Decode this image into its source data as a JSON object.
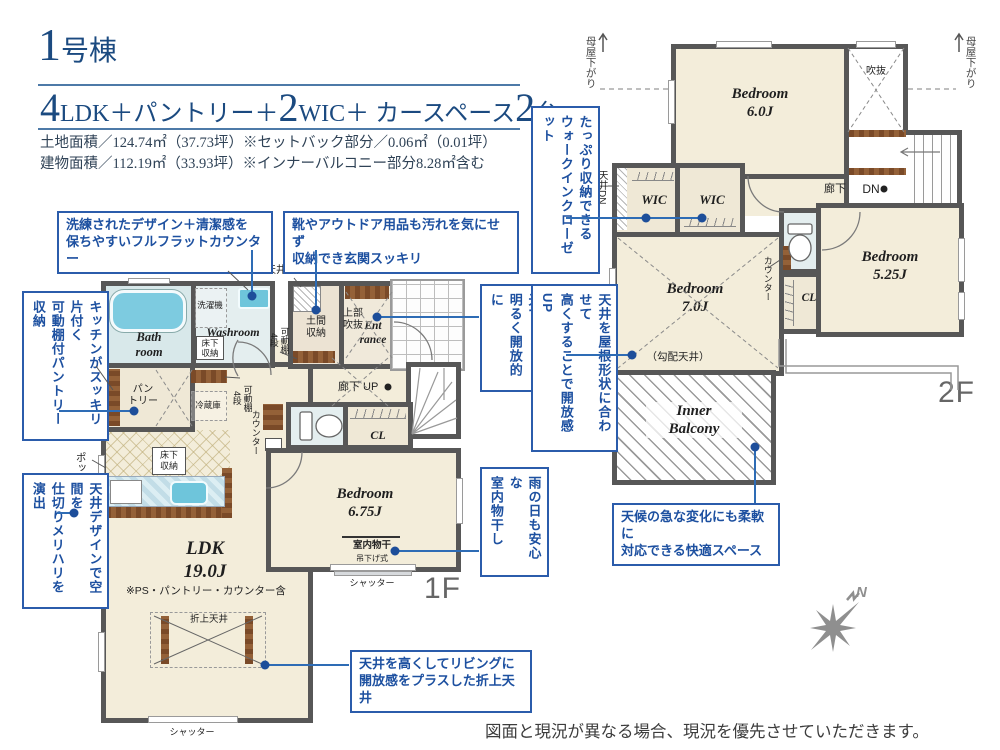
{
  "header": {
    "title_num": "1",
    "title_suffix": "号棟",
    "plan": {
      "n1": "4",
      "t1": "LDK＋パントリー＋",
      "n2": "2",
      "t2": "WIC＋ カースペース",
      "n3": "2",
      "t3": "台"
    },
    "land_area": "土地面積／124.74㎡（37.73坪）※セットバック部分／0.06㎡（0.01坪）",
    "building_area": "建物面積／112.19㎡（33.93坪）※インナーバルコニー部分8.28㎡含む"
  },
  "callouts": {
    "flat_counter": "洗練されたデザイン＋清潔感を\n保ちやすいフルフラットカウンター",
    "genkan": "靴やアウトドア用品も汚れを気にせず\n収納でき玄関スッキリ",
    "pantry": "キッチンがスッキリ片付く\n可動棚付パントリー収納",
    "ceiling_design": "天井デザインで空間を\n仕切りメリハリを演出",
    "void_light": "吹抜からの採光で\n明るく開放的に",
    "indoor_drying": "雨の日も安心な\n室内物干し",
    "oriage": "天井を高くしてリビングに\n開放感をプラスした折上天井",
    "wic": "たっぷり収納できる\nウォークインクローゼット",
    "sloped_ceiling": "天井を屋根形状に合わせて\n高くすることで開放感UP",
    "balcony": "天候の急な変化にも柔軟に\n対応できる快適スペース"
  },
  "f1": {
    "floor": "1F",
    "bath": "Bath\nroom",
    "washroom": "Washroom",
    "washer": "洗濯機",
    "open_sanitary": "オープンサニタリー\nirodori",
    "ceiling_dn": "天井DN",
    "doma": "土間\n収納",
    "upper_void": "上部\n吹抜",
    "entrance": "Ent\nrance",
    "hallway_up": "廊下 UP",
    "shelf_a": "可動棚\n4段",
    "shelf_b": "可動棚\n4段",
    "shelf_c": "可動棚\n4段",
    "pantry": "パン\nトリー",
    "fridge": "冷蔵庫",
    "underfloor_wash": "床下\n収納",
    "underfloor_kitchen": "床下\n収納",
    "counter": "カウンター",
    "ps": "PS",
    "cl": "CL",
    "bedroom": "Bedroom\n6.75J",
    "monohoshi": "室内物干",
    "monohoshi_sub": "吊下げ式",
    "shutter_bedroom": "シャッター",
    "shutter_ldk": "シャッター",
    "ldk": "LDK\n19.0J",
    "ldk_note": "※PS・パントリー・カウンター含",
    "oriage": "折上天井",
    "popup": "ポップアップ天井"
  },
  "f2": {
    "floor": "2F",
    "bedroom6": "Bedroom\n6.0J",
    "void": "吹抜",
    "hallway": "廊下",
    "dn": "DN",
    "ceiling_dn": "天井DN",
    "wic1": "WIC",
    "wic2": "WIC",
    "bedroom7": "Bedroom\n7.0J",
    "slope_note": "（勾配天井）",
    "counter": "カウンター",
    "cl": "CL",
    "bedroom525": "Bedroom\n5.25J",
    "inner_balcony": "Inner\nBalcony",
    "moya_left": "母屋下がり",
    "moya_right": "母屋下がり"
  },
  "compass": {
    "north": "N"
  },
  "footer": {
    "disclaimer": "図面と現況が異なる場合、現況を優先させていただきます。"
  },
  "colors": {
    "accent_blue": "#2b5cab",
    "navy": "#1b4a80",
    "wall": "#575757"
  }
}
